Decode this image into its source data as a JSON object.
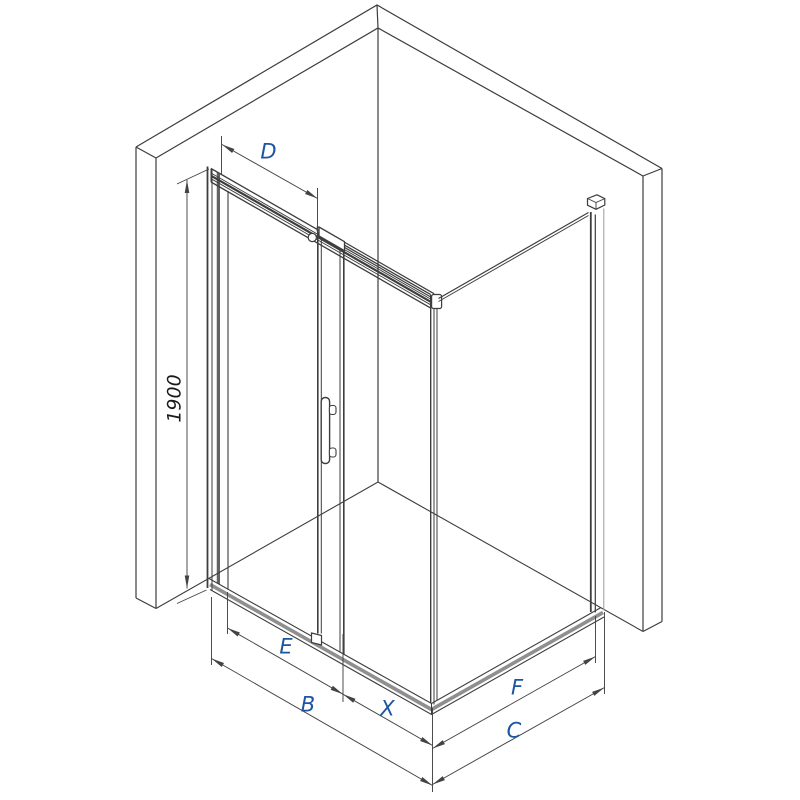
{
  "labels": {
    "d": "D",
    "height": "1900",
    "e": "E",
    "b": "B",
    "x": "X",
    "f": "F",
    "c": "C"
  },
  "colors": {
    "line": "#3d3d3d",
    "dim_line": "#434343",
    "dim_label_blue": "#1d55a0",
    "height_label_black": "#1a1a1a",
    "tray_gray": "#8f8f8f",
    "profile_gray": "#9a9a9a",
    "background": "#ffffff"
  }
}
